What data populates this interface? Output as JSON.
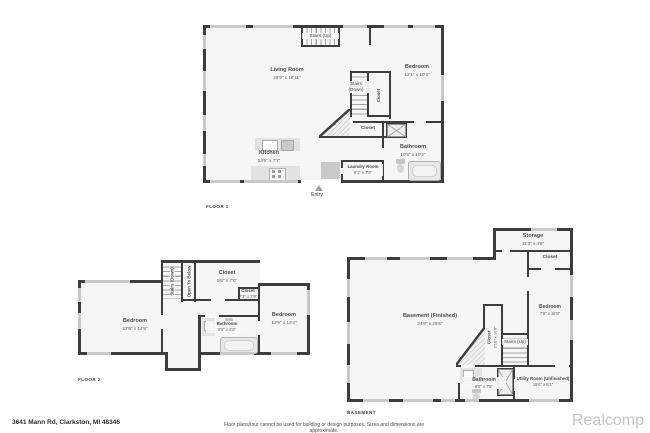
{
  "footer": {
    "address": "3641 Mann Rd, Clarkston, MI 48346",
    "disclaimer": "Floor plans/tour cannot be used for building or design purposes. Sizes and dimensions are approximate.",
    "watermark": "Realcomp"
  },
  "colors": {
    "wall": "#3d3d3d",
    "room": "#f6f6f6",
    "window": "#c9c9c9",
    "fixture": "#e2e2e2"
  },
  "floor1": {
    "title": "FLOOR 1",
    "stairs_up": "Stairs (Up)",
    "living": {
      "name": "Living Room",
      "dims": "28'9\" x 16'11\""
    },
    "bedroom": {
      "name": "Bedroom",
      "dims": "12'1\" x 10'4\""
    },
    "stairs_down": "Stairs (Down)",
    "closet_stairs": "Closet",
    "fireplace": "Fireplace",
    "closet_hall": "Closet",
    "kitchen": {
      "name": "Kitchen",
      "dims": "23'6\" x 7'7\""
    },
    "bathroom": {
      "name": "Bathroom",
      "dims": "10'5\" x 10'2\""
    },
    "laundry": {
      "name": "Laundry Room",
      "dims": "9'1\" x 7'9\""
    },
    "entry": "Entry"
  },
  "floor2": {
    "title": "FLOOR 2",
    "stairs_down": "Stairs (Down)",
    "open_below": "Open To Below",
    "closet_top": {
      "name": "Closet",
      "dims": "9'6\" x 7'0\""
    },
    "closet_small": {
      "name": "Closet",
      "dims": "7'3\" x 2'9\""
    },
    "bedroom_left": {
      "name": "Bedroom",
      "dims": "22'6\" x 14'9\""
    },
    "bedroom_right": {
      "name": "Bedroom",
      "dims": "13'9\" x 12'3\""
    },
    "bathroom": {
      "name": "Bathroom",
      "dims": "9'6\" x 4'5\""
    }
  },
  "basement": {
    "title": "BASEMENT",
    "storage": {
      "name": "Storage",
      "dims": "11'3\" x 4'9\""
    },
    "closet_top": "Closet",
    "main": {
      "name": "Basement (Finished)",
      "dims": "24'8\" x 25'5\""
    },
    "closet_stairs": {
      "name": "Closet",
      "dims": "2'10\" x 10'8\""
    },
    "stairs_up": "Stairs (Up)",
    "bedroom": {
      "name": "Bedroom",
      "dims": "7'9\" x 16'8\""
    },
    "bathroom": {
      "name": "Bathroom",
      "dims": "8'9\" x 7'9\""
    },
    "utility": {
      "name": "Utility Room (Unfinished)",
      "dims": "19'6\" x 8'1\""
    }
  }
}
